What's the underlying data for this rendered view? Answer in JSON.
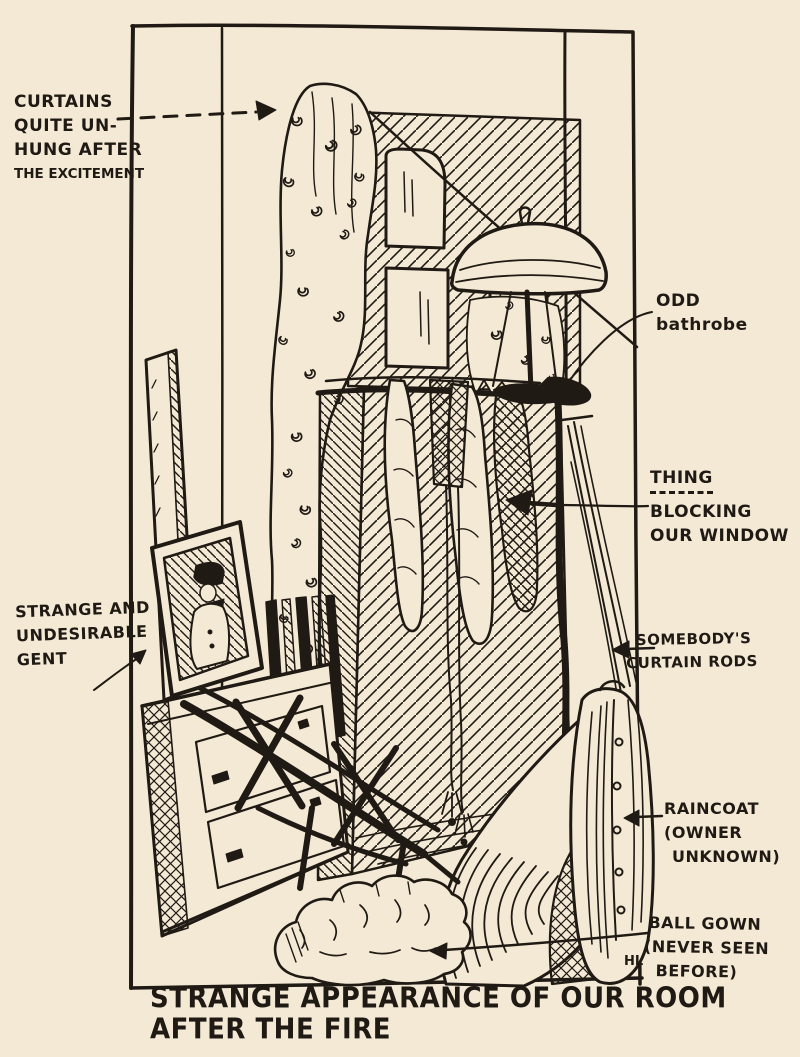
{
  "colors": {
    "paper": "#f3e9d5",
    "ink": "#201a14"
  },
  "labels": {
    "curtains": {
      "lines": [
        "CURTAINS",
        "QUITE UN-",
        "HUNG AFTER",
        "THE EXCITEMENT"
      ]
    },
    "bathrobe": {
      "lines": [
        "ODD",
        "bathrobe"
      ]
    },
    "thing": {
      "title": "THING",
      "lines": [
        "BLOCKING",
        "OUR WINDOW"
      ]
    },
    "rods": {
      "lines": [
        "SOMEBODY'S",
        "CURTAIN RODS"
      ]
    },
    "gent": {
      "lines": [
        "STRANGE AND",
        "UNDESIRABLE",
        "GENT"
      ]
    },
    "raincoat": {
      "lines": [
        "RAINCOAT",
        "(OWNER",
        "UNKNOWN)"
      ]
    },
    "ballgown": {
      "lines": [
        "BALL GOWN",
        "(NEVER SEEN",
        "BEFORE)"
      ]
    }
  },
  "caption": {
    "lines": [
      "STRANGE APPEARANCE OF OUR ROOM",
      "AFTER THE FIRE"
    ]
  },
  "signature": "HL"
}
